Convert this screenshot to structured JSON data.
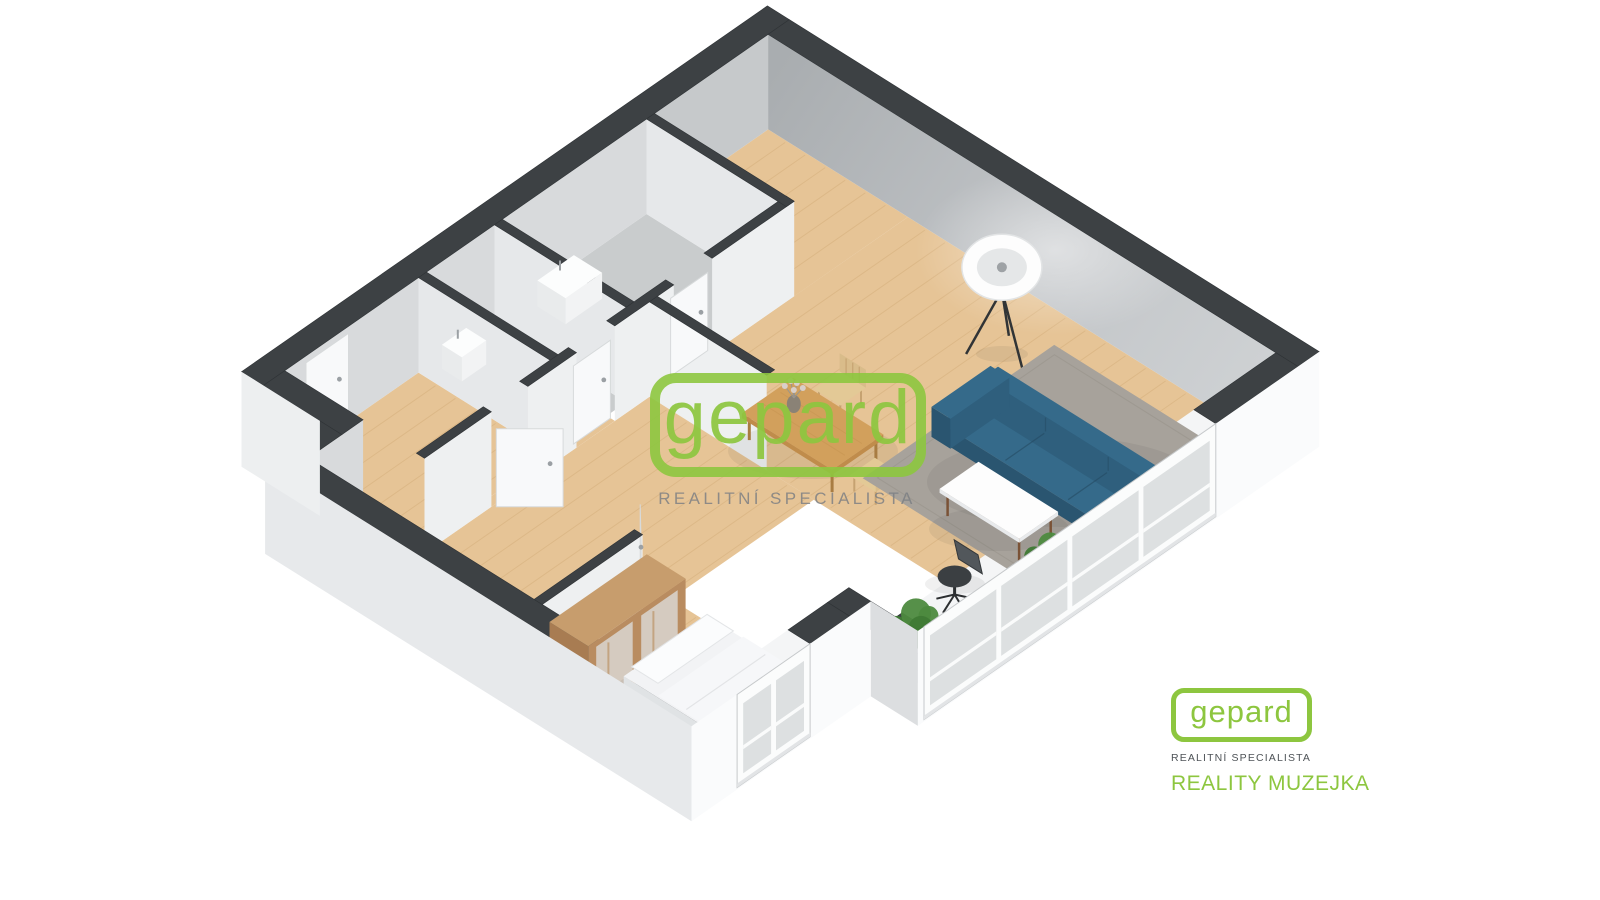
{
  "scene": {
    "type": "3d-floor-plan"
  },
  "watermark": {
    "brand": "gepard",
    "tagline": "REALITNÍ SPECIALISTA"
  },
  "logo": {
    "brand": "gepard",
    "tagline": "REALITNÍ SPECIALISTA",
    "agency": "REALITY MUZEJKA"
  },
  "colors": {
    "brand_green": "#8dc63f",
    "watermark_gray": "#7a7e82",
    "logo_tagline_gray": "#4e5357",
    "wall_cap": "#3d4144",
    "wall_cap_line": "#2f3336",
    "wall_exterior_white": "#fafbfc",
    "wall_exterior_gray": "#e7e9eb",
    "wall_step_gray": "#edeff0",
    "wall_notch_gray": "#dcdee0",
    "wall_interior_gray": "#aeb2b5",
    "wall_interior_gray2": "#c6c9cb",
    "wall_interior_med": "#d8dadc",
    "wall_interior_light": "#eef0f1",
    "wall_divider_face": "#e6e8ea",
    "floor_wood": "#e6c496",
    "floor_wood_line": "#c9a06a",
    "floor_tile": "#c9cccd",
    "sill_white": "#f4f5f6",
    "window_frame": "#fbfcfc",
    "window_frame_line": "#c6c9cb",
    "window_glass": "#dde0e1",
    "door_white": "#f8f9fa",
    "door_line": "#d7dadb",
    "handle_gray": "#9ba0a4",
    "rug_gray": "#a7a29b",
    "rug_edge": "#97928b",
    "sofa_teal": "#2f5f7d",
    "sofa_teal_dark": "#2a5570",
    "sofa_teal_top": "#356a8a",
    "sofa_seam": "#254b63",
    "dining_wood": "#d2a05c",
    "dining_wood_edge": "#c08c4b",
    "leg_wood": "#a87c42",
    "chair_wood": "#e3c996",
    "chair_wood_back": "#d9bc8a",
    "chair_wood_leg": "#c6a271",
    "coffee_table_white": "#fdfdfd",
    "coffee_leg_brown": "#7a5236",
    "wardrobe_top": "#c79d6d",
    "wardrobe_front": "#b98c60",
    "wardrobe_side": "#a87c52",
    "wardrobe_mirror": "#d9d6d1",
    "bed_top": "#f2f3f5",
    "bed_side": "#e0e3e5",
    "bed_front": "#e8eaec",
    "pillow_white": "#fbfcfd",
    "desk_white": "#fbfcfd",
    "laptop_dark": "#2e3134",
    "office_chair_dark": "#3b3f42",
    "office_chair_mesh": "#52575b",
    "plant_green_dark": "#3f7a35",
    "plant_green": "#4d8a3f",
    "plant_green_light": "#5ca04b",
    "pot_white": "#eceded",
    "lamp_white": "#fdfdfd",
    "lamp_inner": "#d2d5d7",
    "lamp_leg": "#313436",
    "fixture_white": "#fcfdfd",
    "vase_gray": "#8a8276",
    "blossom": "#d9cfc9",
    "shadow": "#2b2e30"
  }
}
